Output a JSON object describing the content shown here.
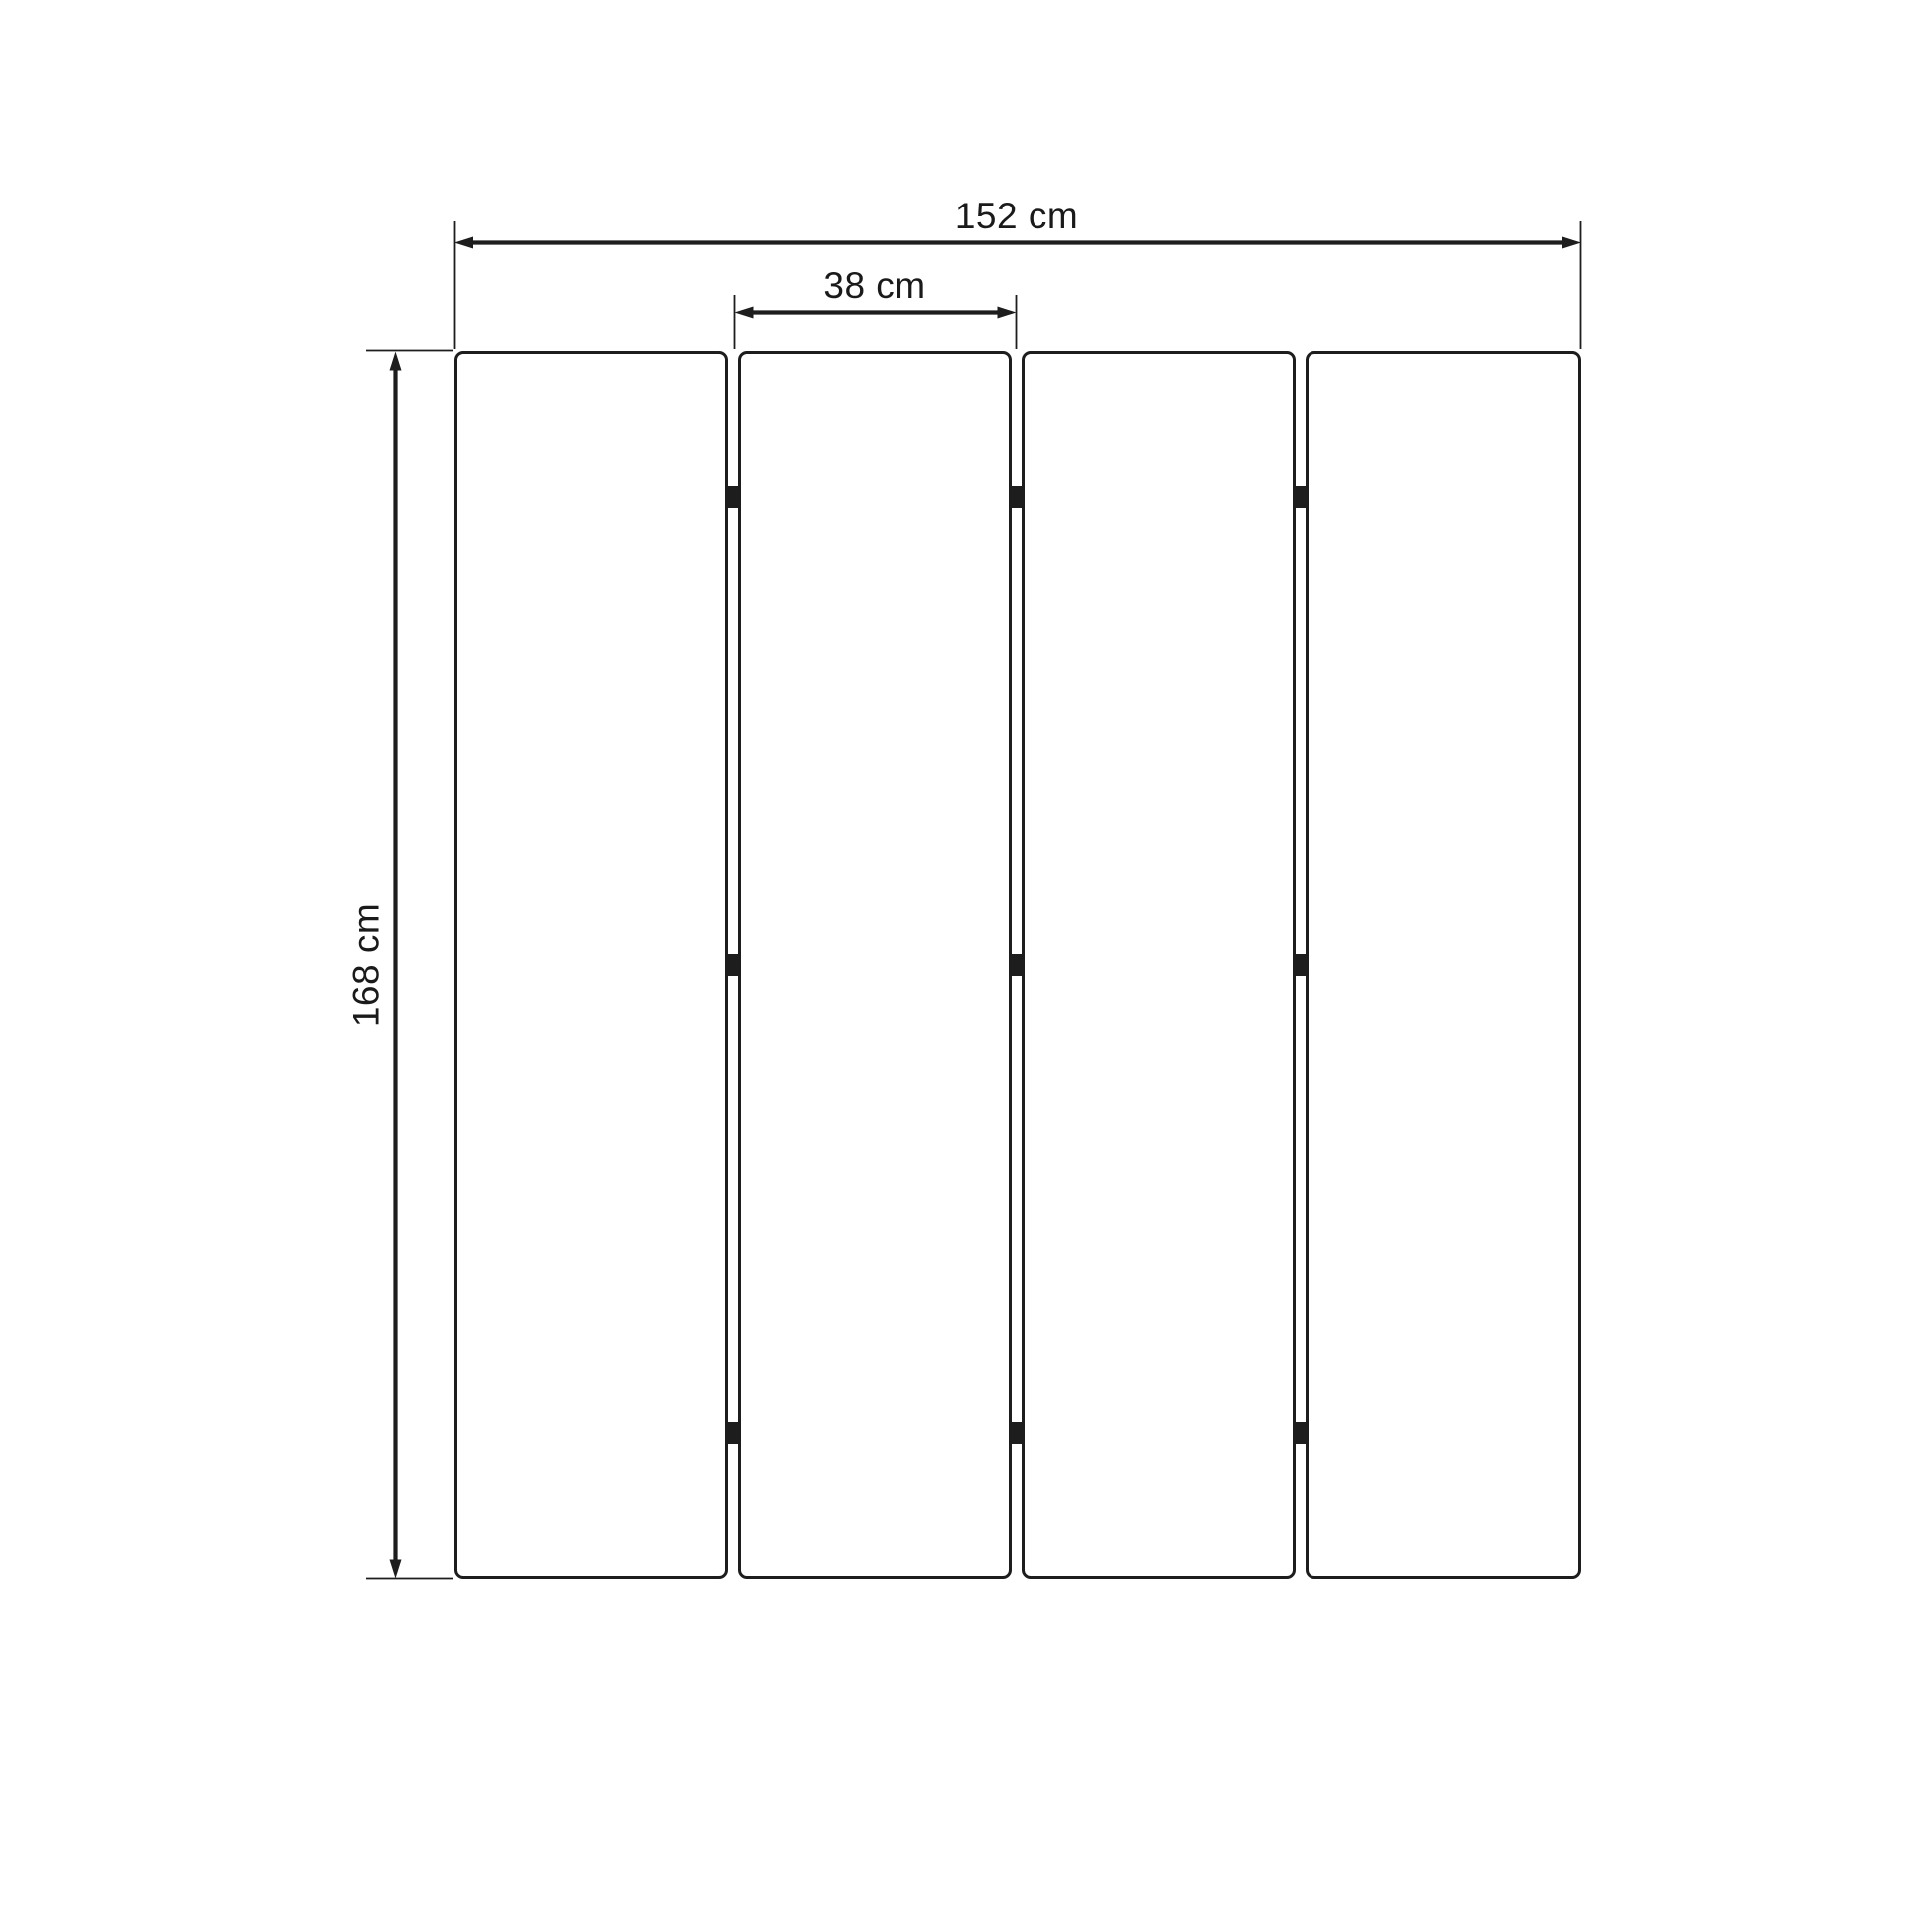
{
  "diagram": {
    "kind": "panel-dimension-drawing",
    "panel_count": 4,
    "hinges_per_gap": 3,
    "colors": {
      "line": "#1d1d1d",
      "background": "#ffffff"
    },
    "dimensions": {
      "total_width": "152 cm",
      "panel_width": "38 cm",
      "height": "168 cm"
    }
  }
}
